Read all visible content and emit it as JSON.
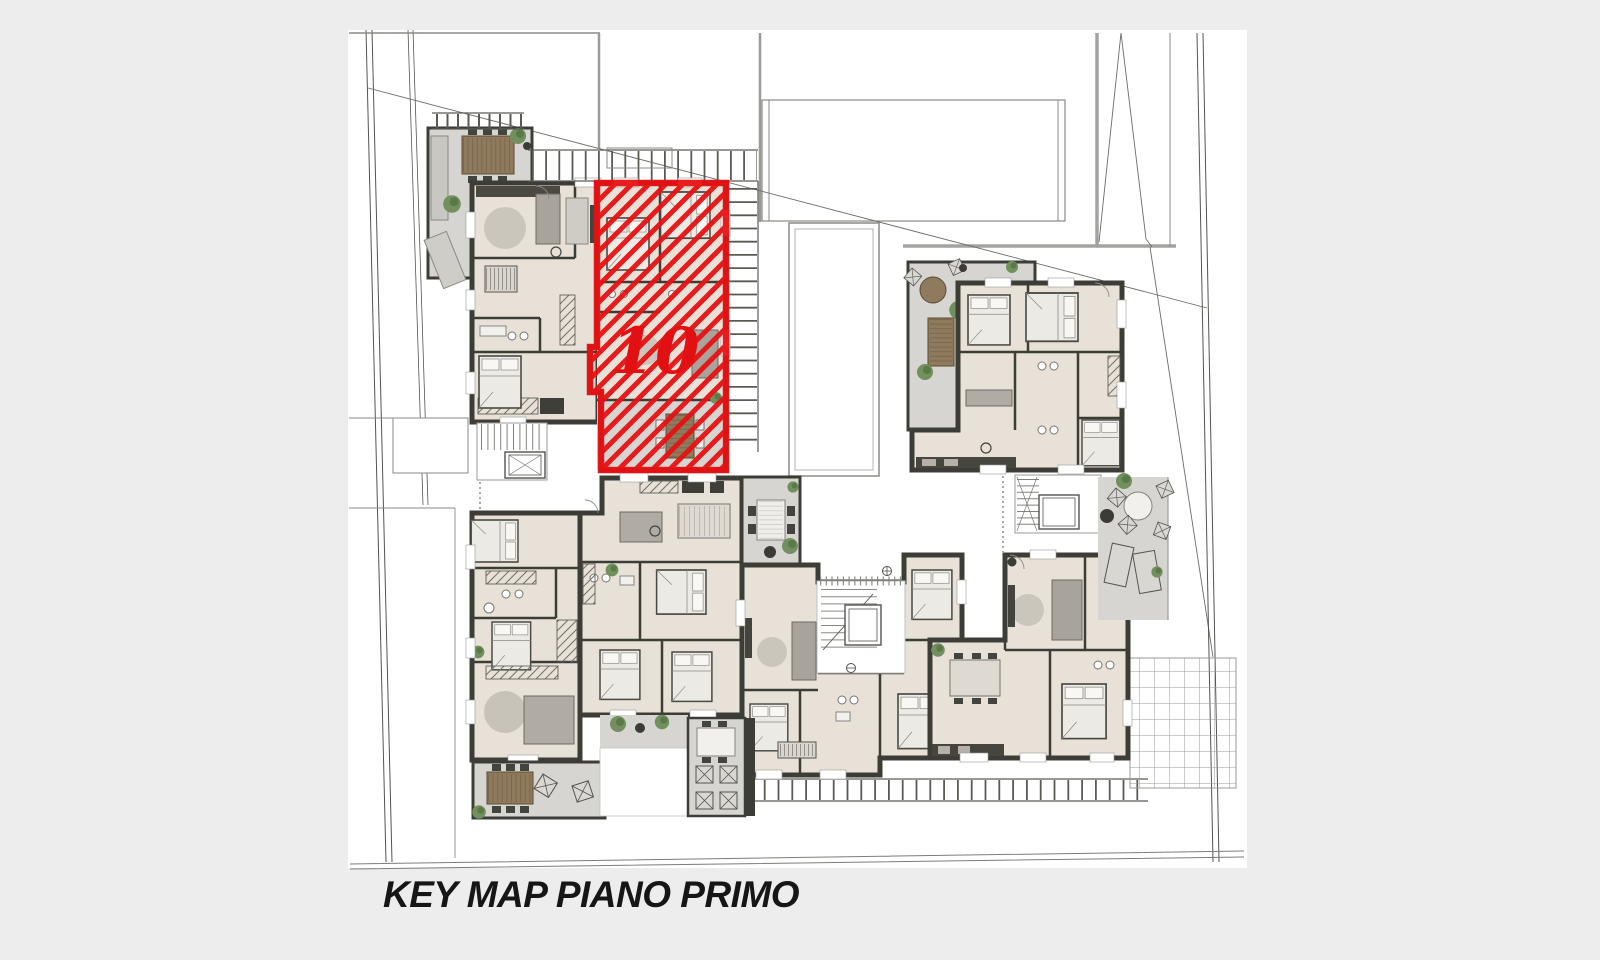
{
  "page": {
    "background_color": "#ededed",
    "sheet_color": "#ffffff"
  },
  "key_map": {
    "caption": "KEY MAP PIANO PRIMO",
    "highlighted_unit": {
      "label": "10",
      "highlight_color": "#e81113"
    },
    "palette": {
      "wall": "#3d3d37",
      "room_floor": "#e7e1d7",
      "terrace": "#d6d5d2",
      "wood_furniture": "#8f7a5e",
      "plant_green": "#71905d",
      "site_line": "#55534f"
    }
  }
}
